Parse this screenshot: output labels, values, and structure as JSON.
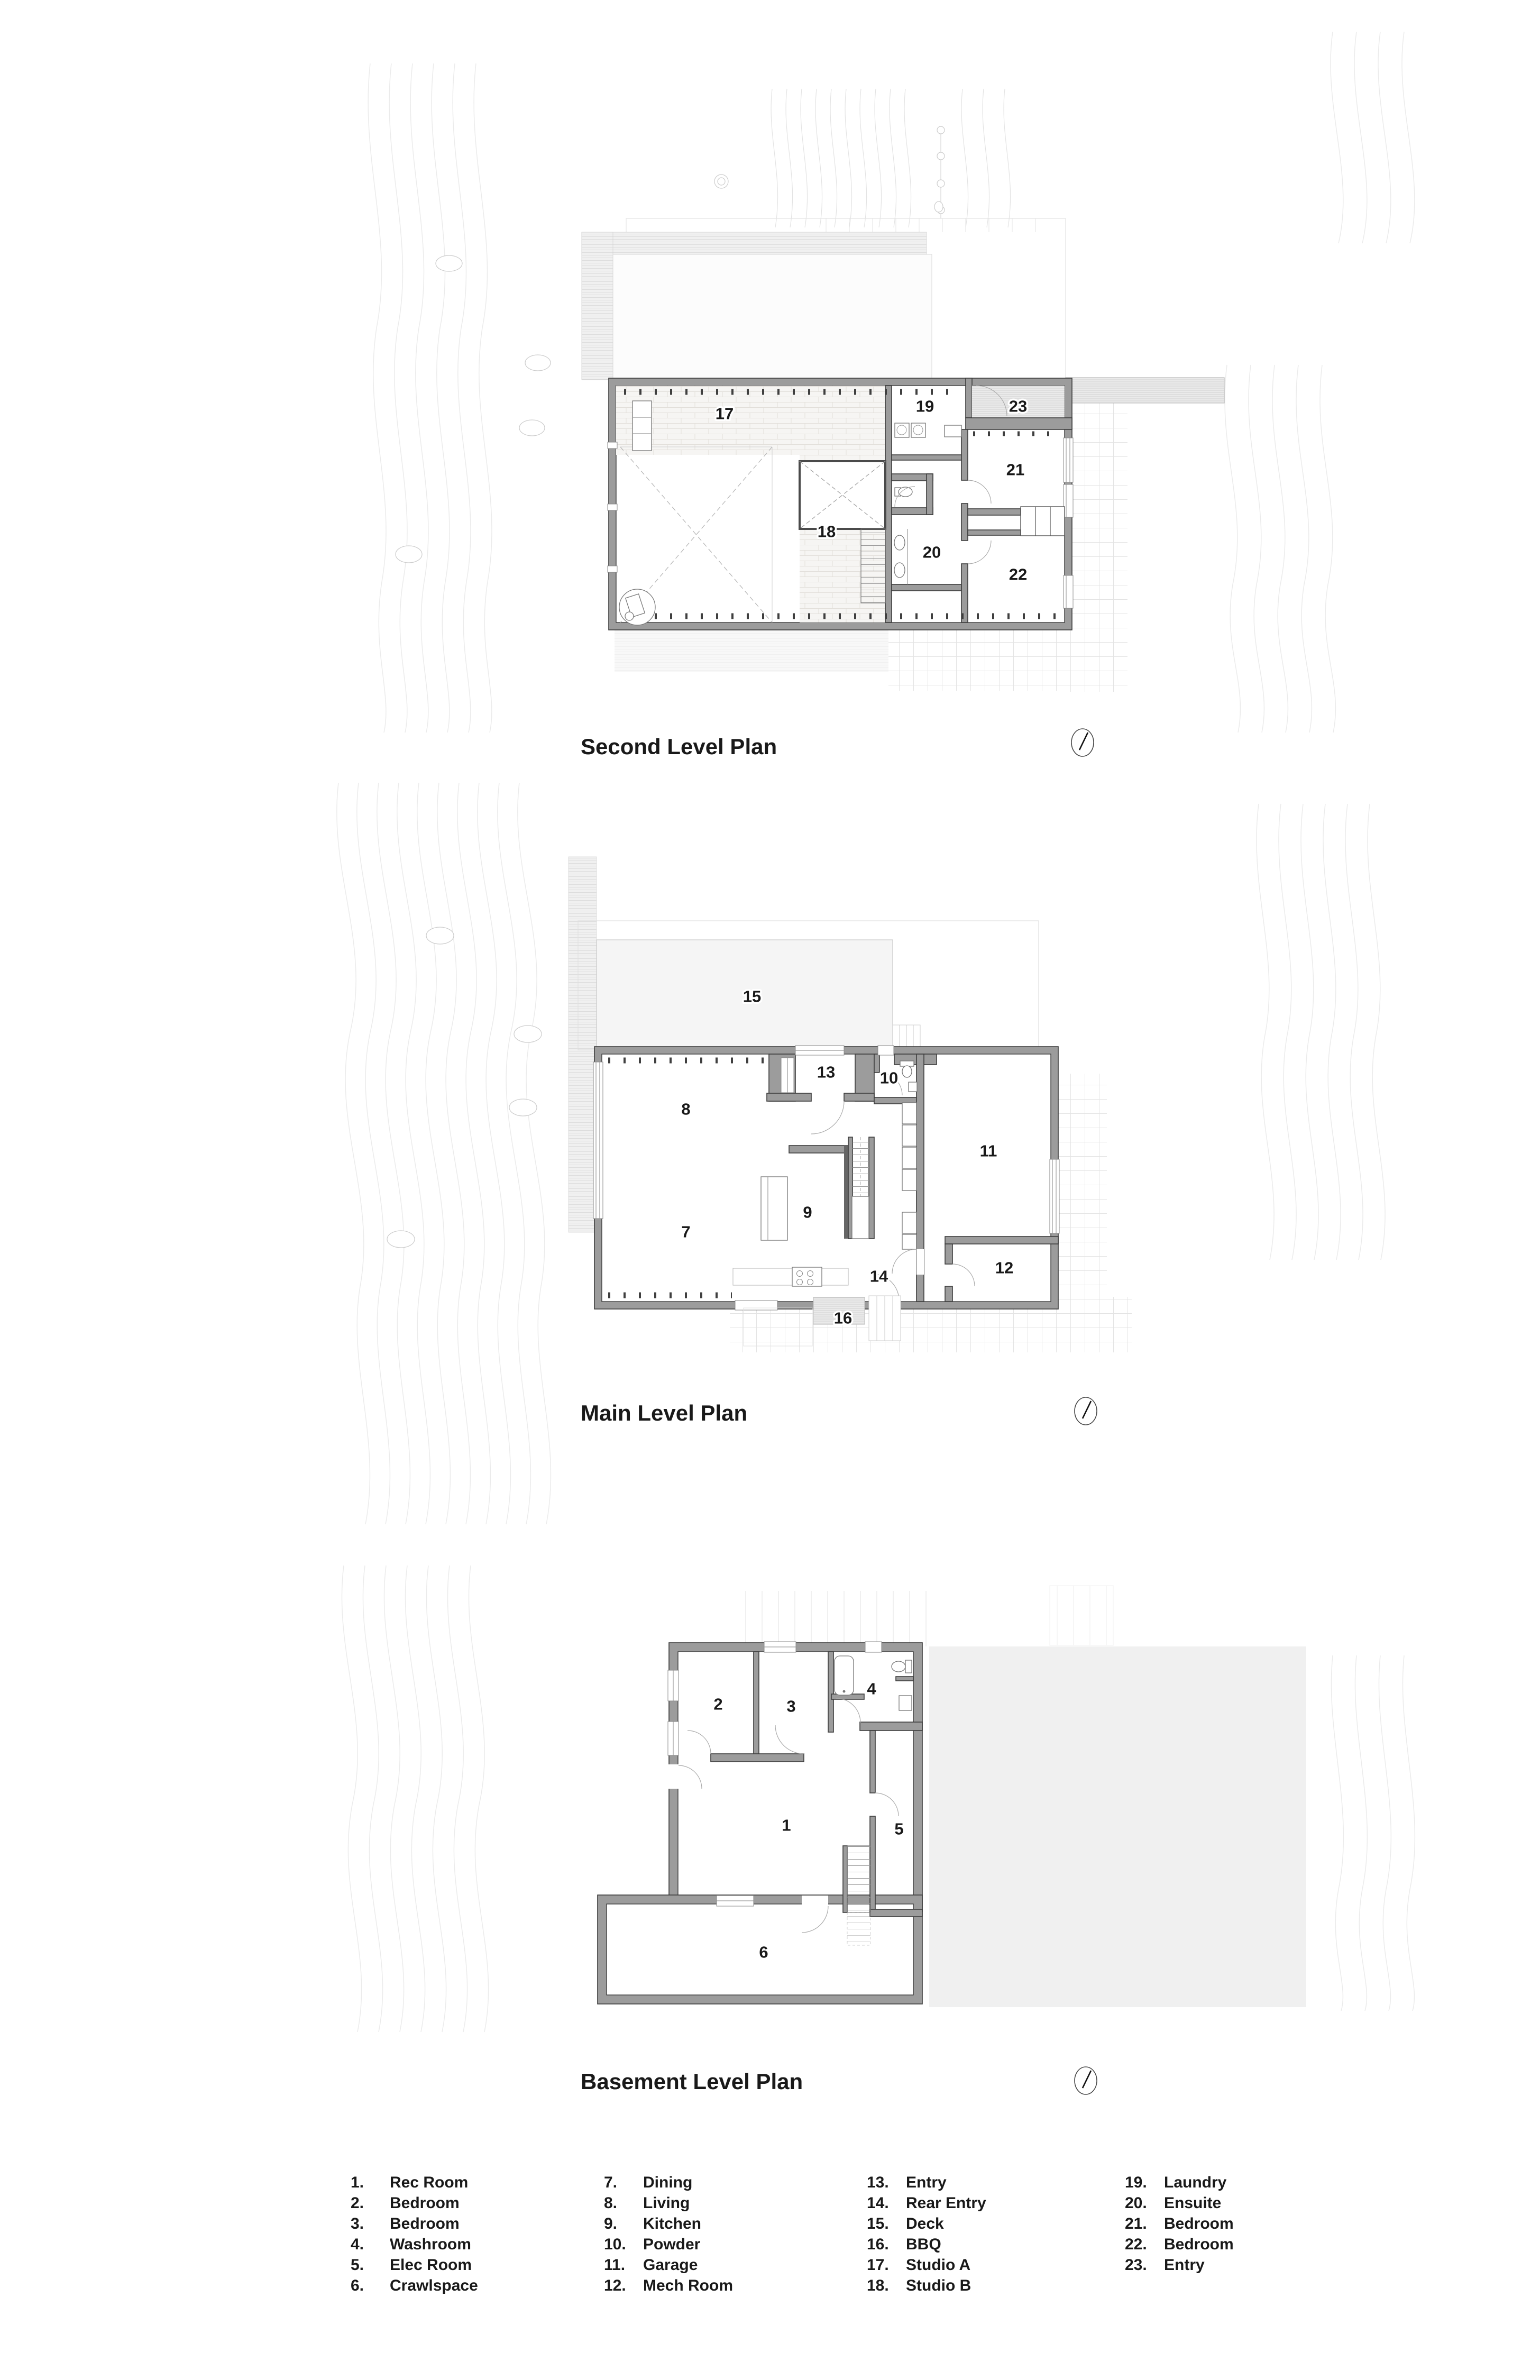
{
  "sheet": {
    "background": "#ffffff"
  },
  "colors": {
    "wall_fill": "#9c9c9c",
    "wall_edge": "#3d3d3d",
    "label_text": "#191919",
    "hatch_line": "#d5d5d5",
    "tile_grid": "#e4e4e4",
    "backdrop": "#f0f0f0",
    "contour": "#ebebeb"
  },
  "icons": {
    "north_arrow": "north-arrow-compass"
  },
  "plans": {
    "second": {
      "title": "Second Level Plan",
      "rooms": {
        "r17": "17",
        "r18": "18",
        "r19": "19",
        "r20": "20",
        "r21": "21",
        "r22": "22",
        "r23": "23"
      }
    },
    "main": {
      "title": "Main Level Plan",
      "rooms": {
        "r7": "7",
        "r8": "8",
        "r9": "9",
        "r10": "10",
        "r11": "11",
        "r12": "12",
        "r13": "13",
        "r14": "14",
        "r15": "15",
        "r16": "16"
      }
    },
    "basement": {
      "title": "Basement Level Plan",
      "rooms": {
        "r1": "1",
        "r2": "2",
        "r3": "3",
        "r4": "4",
        "r5": "5",
        "r6": "6"
      }
    }
  },
  "legend": {
    "items": [
      {
        "num": "1.",
        "label": "Rec Room"
      },
      {
        "num": "2.",
        "label": "Bedroom"
      },
      {
        "num": "3.",
        "label": "Bedroom"
      },
      {
        "num": "4.",
        "label": "Washroom"
      },
      {
        "num": "5.",
        "label": "Elec Room"
      },
      {
        "num": "6.",
        "label": "Crawlspace"
      },
      {
        "num": "7.",
        "label": "Dining"
      },
      {
        "num": "8.",
        "label": "Living"
      },
      {
        "num": "9.",
        "label": "Kitchen"
      },
      {
        "num": "10.",
        "label": "Powder"
      },
      {
        "num": "11.",
        "label": "Garage"
      },
      {
        "num": "12.",
        "label": "Mech Room"
      },
      {
        "num": "13.",
        "label": "Entry"
      },
      {
        "num": "14.",
        "label": "Rear Entry"
      },
      {
        "num": "15.",
        "label": "Deck"
      },
      {
        "num": "16.",
        "label": "BBQ"
      },
      {
        "num": "17.",
        "label": "Studio A"
      },
      {
        "num": "18.",
        "label": "Studio B"
      },
      {
        "num": "19.",
        "label": "Laundry"
      },
      {
        "num": "20.",
        "label": "Ensuite"
      },
      {
        "num": "21.",
        "label": "Bedroom"
      },
      {
        "num": "22.",
        "label": "Bedroom"
      },
      {
        "num": "23.",
        "label": "Entry"
      }
    ]
  }
}
